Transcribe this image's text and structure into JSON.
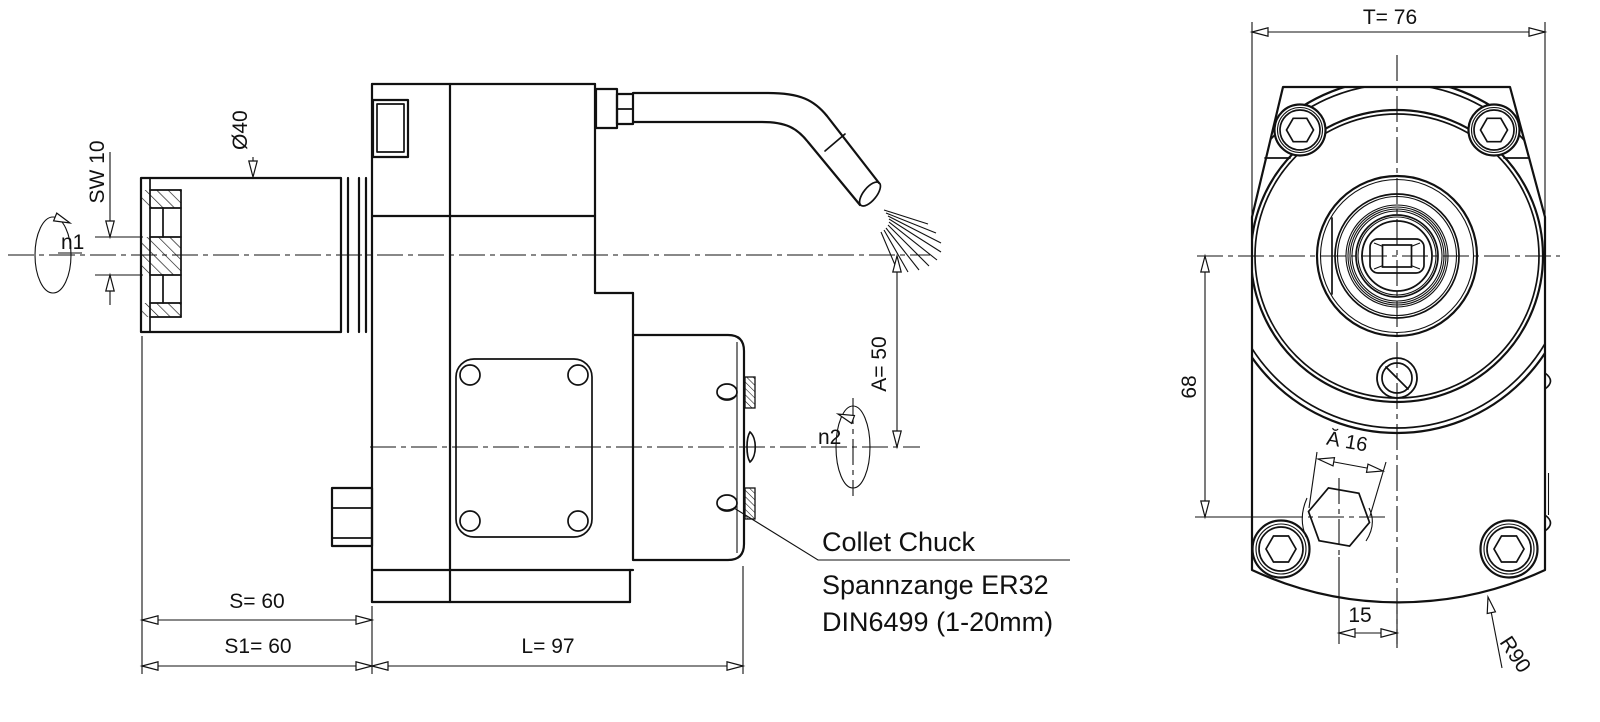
{
  "drawing": {
    "side_view": {
      "n1_label": "n1",
      "sw_label": "SW 10",
      "diameter_label": "Ø40",
      "a_label": "A= 50",
      "n2_label": "n2",
      "s_label": "S= 60",
      "s1_label": "S1= 60",
      "l_label": "L= 97",
      "callout_line1": "Collet Chuck",
      "callout_line2": "Spannzange ER32",
      "callout_line3": "DIN6499 (1-20mm)"
    },
    "front_view": {
      "t_label": "T= 76",
      "height_label": "68",
      "hex_label": "Ă 16",
      "offset_label": "15",
      "radius_label": "R90"
    },
    "colors": {
      "line": "#111111",
      "background": "#ffffff"
    }
  }
}
